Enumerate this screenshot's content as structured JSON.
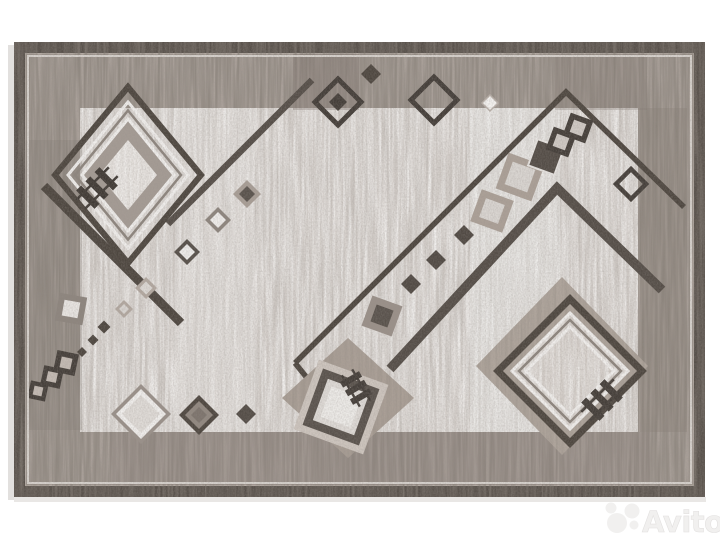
{
  "image": {
    "kind": "product-photo",
    "subject": "gray geometric area rug with diamond and square motifs",
    "background": "white"
  },
  "watermark": {
    "text": "Avito",
    "logo_icon": "avito-circles-logo",
    "color": "#f1f0ef"
  },
  "palette": {
    "photo_background": "#ffffff",
    "rug_field_taupe": "#b6ada6",
    "border_band_dark": "#57504a",
    "border_speckle": "#99908a",
    "inner_panel_light": "#dcd7d3",
    "motif_dark": "#4e4740",
    "motif_mid_gray": "#8d857e",
    "motif_taupe": "#aba097",
    "motif_white": "#f0eeec",
    "plate_taupe": "#b0a69d"
  },
  "motifs": {
    "top_left": "large concentric diamond with hash glyph and diagonal band",
    "bottom_right": "large concentric diamond on taupe plate with hash glyph",
    "bottom_center": "leaning square medallion on taupe plate with hash glyph",
    "chains": "diagonal chains of small filled and outlined diamonds and squares",
    "diagonals": "two chevron bands meeting at top-right apex, one long diagonal at top-left"
  }
}
